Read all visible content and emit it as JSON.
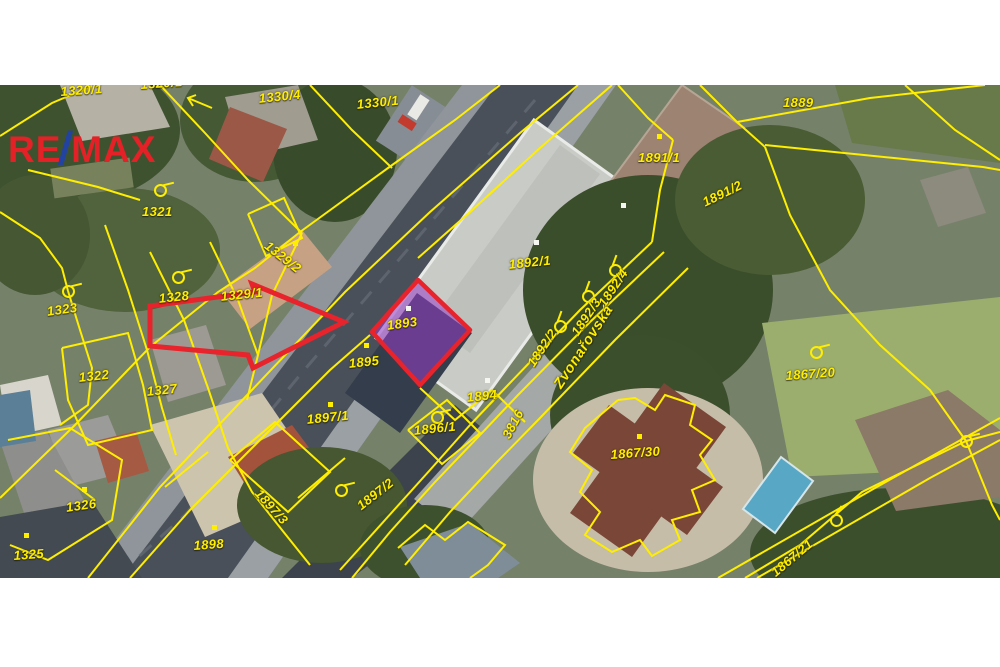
{
  "logo": {
    "re": "RE",
    "slash": "/",
    "max": "MAX"
  },
  "map": {
    "street_name": "Zvonařovská",
    "road_parcel_number": "3816",
    "highlighted_parcel": "1893",
    "colors": {
      "parcel_line": "#ffee00",
      "parcel_label": "#ffee00",
      "highlight_fill": "rgba(152,62,202,0.55)",
      "highlight_border": "#e8232b",
      "arrow": "#e8232b",
      "logo_red": "#e32126",
      "logo_blue": "#2343a0"
    },
    "labels": [
      {
        "text": "1320/1",
        "x": 60,
        "y": 84,
        "rot": -4
      },
      {
        "text": "1320/1",
        "x": 140,
        "y": 77,
        "rot": -4
      },
      {
        "text": "1330/4",
        "x": 258,
        "y": 91,
        "rot": -6
      },
      {
        "text": "1330/1",
        "x": 356,
        "y": 97,
        "rot": -6
      },
      {
        "text": "1889",
        "x": 783,
        "y": 95,
        "rot": 0
      },
      {
        "text": "1891/1",
        "x": 638,
        "y": 150,
        "rot": 0
      },
      {
        "text": "1891/2",
        "x": 700,
        "y": 196,
        "rot": -26
      },
      {
        "text": "1321",
        "x": 142,
        "y": 204,
        "rot": 0
      },
      {
        "text": "1323",
        "x": 46,
        "y": 304,
        "rot": -8
      },
      {
        "text": "1328",
        "x": 158,
        "y": 291,
        "rot": -6
      },
      {
        "text": "1329/1",
        "x": 220,
        "y": 289,
        "rot": -6
      },
      {
        "text": "1329/2",
        "x": 271,
        "y": 238,
        "rot": 38
      },
      {
        "text": "1322",
        "x": 78,
        "y": 370,
        "rot": -6
      },
      {
        "text": "1327",
        "x": 146,
        "y": 384,
        "rot": -6
      },
      {
        "text": "1892/1",
        "x": 508,
        "y": 257,
        "rot": -6
      },
      {
        "text": "1893",
        "x": 386,
        "y": 318,
        "rot": -8
      },
      {
        "text": "1895",
        "x": 348,
        "y": 356,
        "rot": -6
      },
      {
        "text": "1894",
        "x": 466,
        "y": 390,
        "rot": -6
      },
      {
        "text": "1896/1",
        "x": 413,
        "y": 423,
        "rot": -6
      },
      {
        "text": "1897/1",
        "x": 306,
        "y": 412,
        "rot": -6
      },
      {
        "text": "1892/2",
        "x": 524,
        "y": 361,
        "rot": -56
      },
      {
        "text": "1892/3",
        "x": 568,
        "y": 330,
        "rot": -56
      },
      {
        "text": "1892/4",
        "x": 595,
        "y": 301,
        "rot": -56
      },
      {
        "text": "Zvonařovská",
        "x": 551,
        "y": 383,
        "rot": -57,
        "kind": "street"
      },
      {
        "text": "3816",
        "x": 499,
        "y": 434,
        "rot": -62
      },
      {
        "text": "1867/20",
        "x": 785,
        "y": 368,
        "rot": -4
      },
      {
        "text": "1867/30",
        "x": 610,
        "y": 447,
        "rot": -4
      },
      {
        "text": "1898",
        "x": 193,
        "y": 538,
        "rot": -4
      },
      {
        "text": "1326",
        "x": 65,
        "y": 500,
        "rot": -8
      },
      {
        "text": "1325",
        "x": 13,
        "y": 548,
        "rot": -4
      },
      {
        "text": "1897/3",
        "x": 263,
        "y": 486,
        "rot": 48
      },
      {
        "text": "1897/2",
        "x": 354,
        "y": 501,
        "rot": -38
      },
      {
        "text": "1867/21",
        "x": 768,
        "y": 568,
        "rot": -40
      }
    ],
    "boundary_markers": [
      {
        "x": 68,
        "y": 291,
        "rot": 0
      },
      {
        "x": 178,
        "y": 277,
        "rot": 0
      },
      {
        "x": 160,
        "y": 190,
        "rot": 0
      },
      {
        "x": 437,
        "y": 417,
        "rot": 0
      },
      {
        "x": 816,
        "y": 352,
        "rot": 0
      },
      {
        "x": 341,
        "y": 490,
        "rot": 0
      },
      {
        "x": 836,
        "y": 520,
        "rot": -40
      },
      {
        "x": 560,
        "y": 326,
        "rot": -56
      },
      {
        "x": 588,
        "y": 296,
        "rot": -56
      },
      {
        "x": 615,
        "y": 270,
        "rot": -56
      },
      {
        "x": 966,
        "y": 441,
        "rot": 0
      }
    ],
    "survey_dots": [
      {
        "x": 330,
        "y": 404,
        "c": "y"
      },
      {
        "x": 366,
        "y": 345,
        "c": "y"
      },
      {
        "x": 214,
        "y": 527,
        "c": "y"
      },
      {
        "x": 84,
        "y": 489,
        "c": "y"
      },
      {
        "x": 26,
        "y": 535,
        "c": "y"
      },
      {
        "x": 639,
        "y": 436,
        "c": "y"
      },
      {
        "x": 295,
        "y": 243,
        "c": "y"
      },
      {
        "x": 659,
        "y": 136,
        "c": "y"
      },
      {
        "x": 408,
        "y": 308,
        "c": "w"
      },
      {
        "x": 487,
        "y": 380,
        "c": "w"
      },
      {
        "x": 536,
        "y": 242,
        "c": "w"
      },
      {
        "x": 623,
        "y": 205,
        "c": "w"
      }
    ]
  }
}
